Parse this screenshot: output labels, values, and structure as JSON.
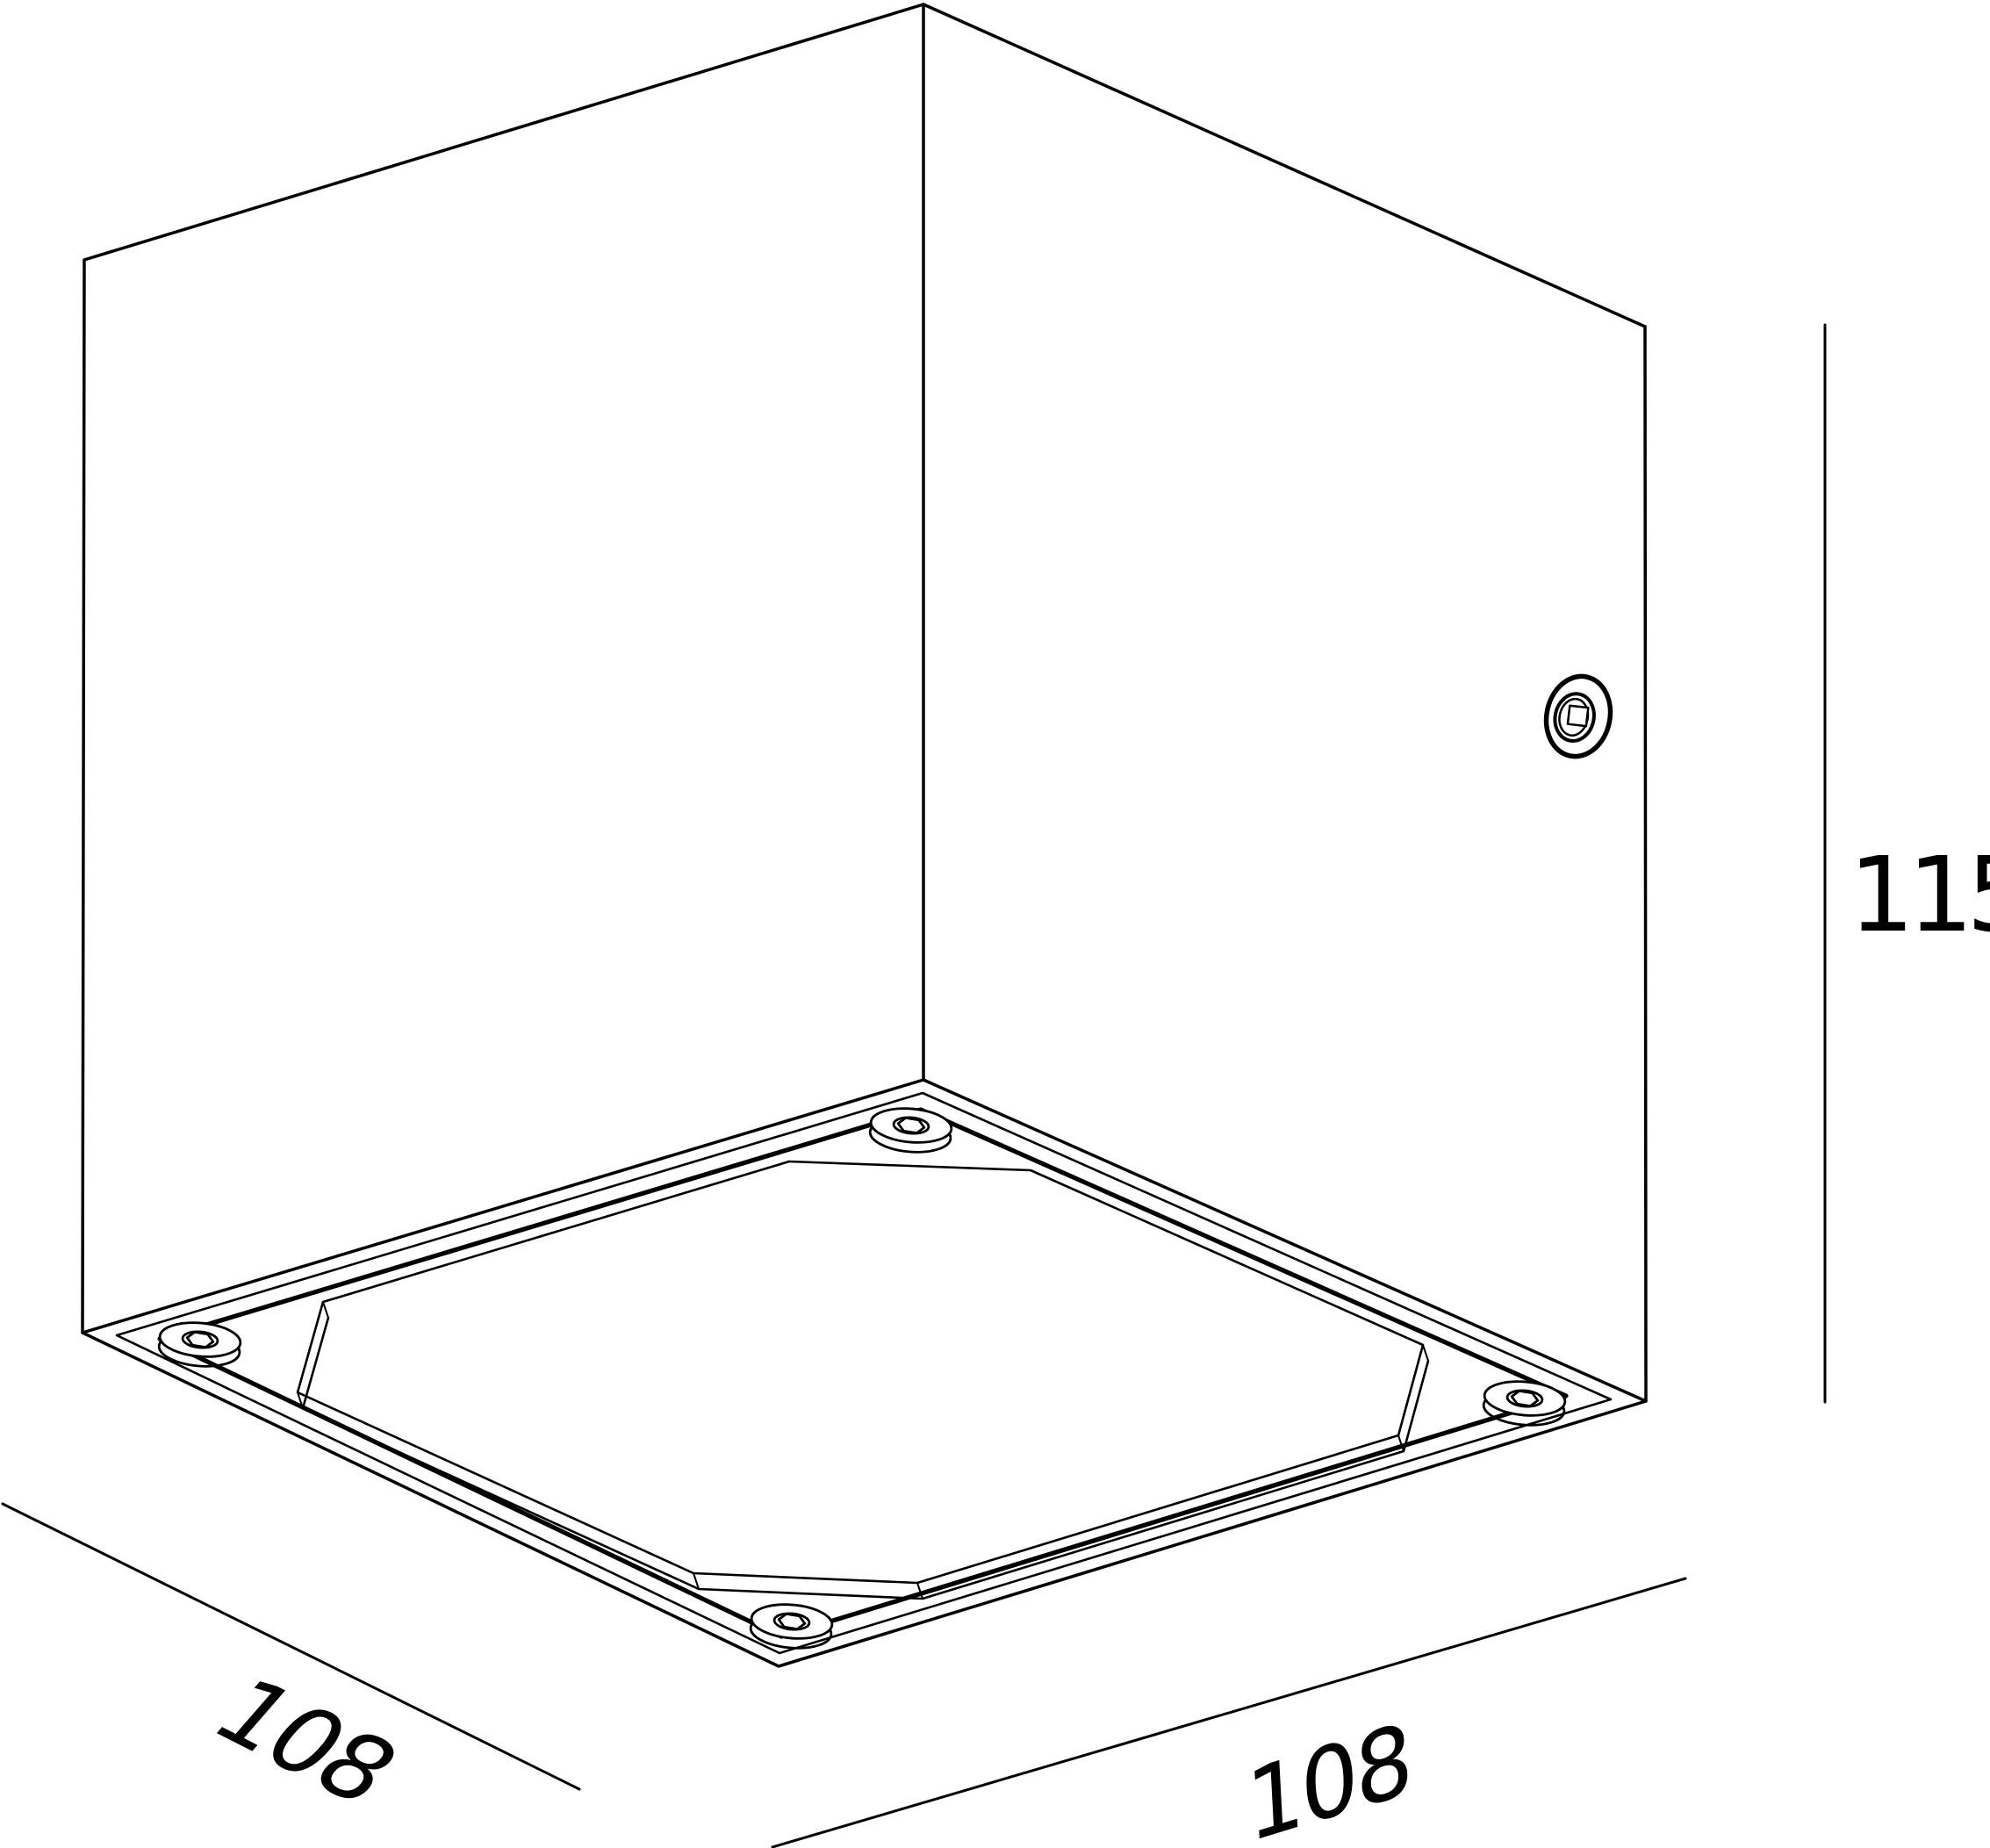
{
  "drawing": {
    "type": "isometric-technical-drawing",
    "subject": "cube-luminaire-bottom-view",
    "dimensions": {
      "bottom_left": "108",
      "bottom_right": "108",
      "height_right": "115"
    },
    "colors": {
      "line": "#000000",
      "background": "#ffffff"
    }
  }
}
